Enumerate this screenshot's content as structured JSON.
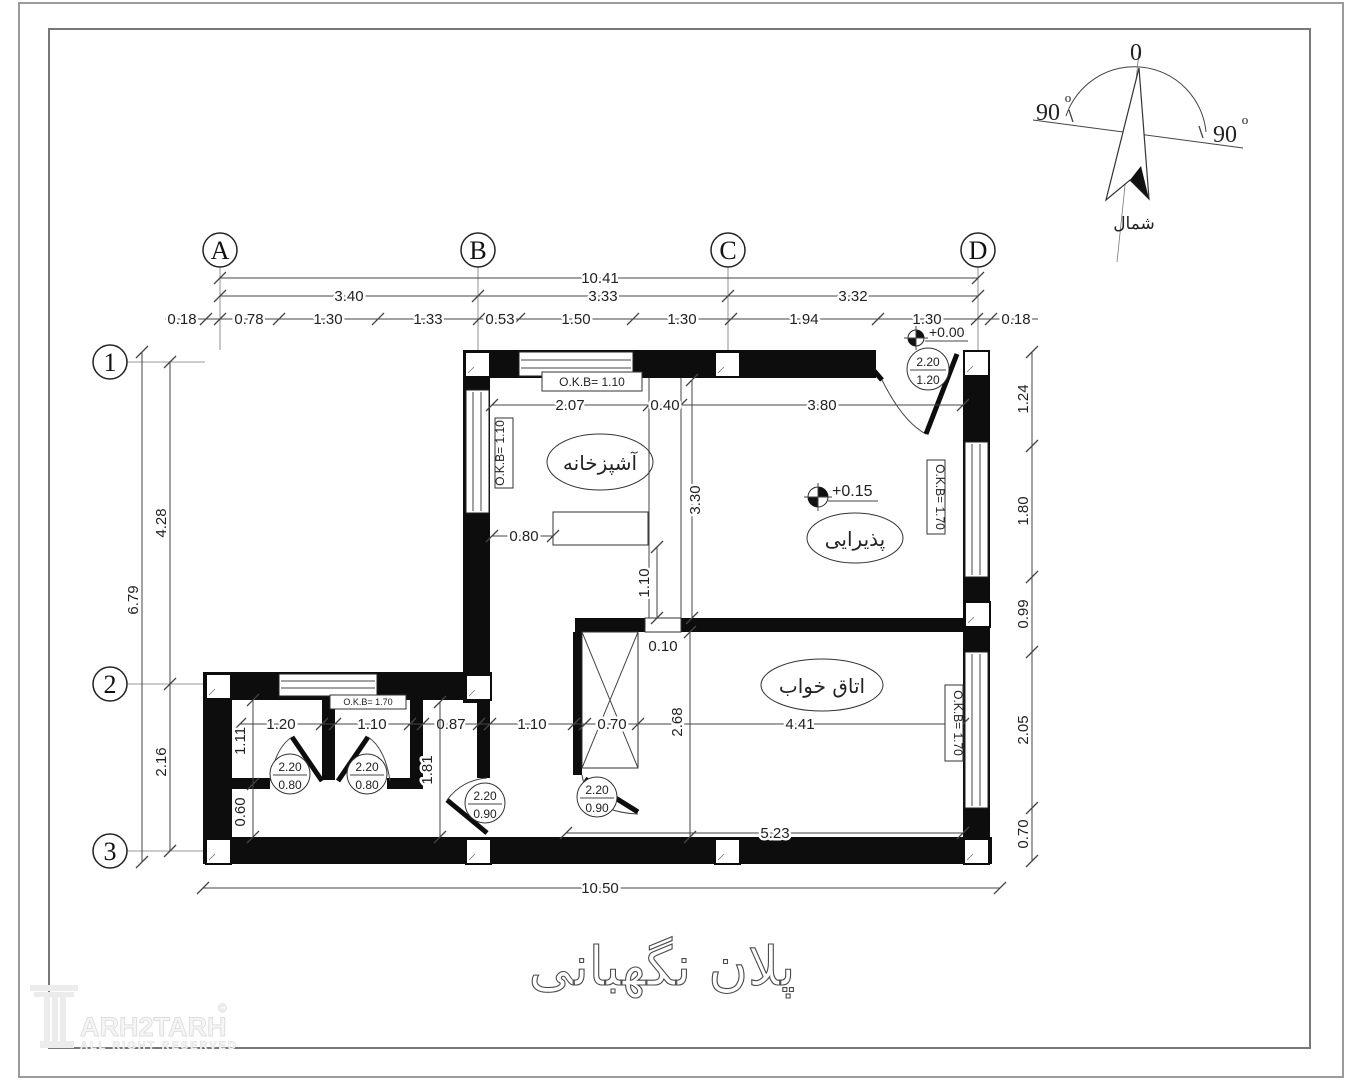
{
  "compass": {
    "zero": "0",
    "left_angle": "90",
    "right_angle": "90",
    "deg": "o",
    "north_label": "شمال"
  },
  "grid_columns": [
    "A",
    "B",
    "C",
    "D"
  ],
  "grid_rows": [
    "1",
    "2",
    "3"
  ],
  "dimensions": {
    "overall_top": "10.41",
    "bay_ab": "3.40",
    "bay_bc": "3.33",
    "bay_cd": "3.32",
    "top_details": [
      "0.18",
      "0.78",
      "1.30",
      "1.33",
      "0.53",
      "1.50",
      "1.30",
      "1.94",
      "1.30",
      "0.18"
    ],
    "left_overall": "6.79",
    "left_12": "4.28",
    "left_23": "2.16",
    "right": [
      "1.24",
      "1.80",
      "0.99",
      "2.05",
      "0.70"
    ],
    "overall_bottom": "10.50",
    "kitchen_width": "2.07",
    "partition_width": "0.40",
    "living_width": "3.80",
    "kitchen_depth": "3.30",
    "counter_offset": "0.80",
    "counter_to_wall": "1.10",
    "wall_niche": "0.10",
    "wc1_width": "1.20",
    "wc2_width": "1.10",
    "hall_width": "0.87",
    "hall_to_shaft": "1.10",
    "shaft_width": "0.70",
    "bedroom_depth": "2.68",
    "bedroom_width": "4.41",
    "bedroom_south": "5.23",
    "wc_depth": "1.11",
    "wc_lower": "0.60",
    "hall_depth": "1.81"
  },
  "rooms": {
    "kitchen": "آشپزخانه",
    "living": "پذیرایی",
    "bedroom": "اتاق خواب"
  },
  "okb_labels": {
    "top_window": "O.K.B= 1.10",
    "left_window": "O.K.B= 1.10",
    "right_upper_window": "O.K.B= 1.70",
    "right_lower_window": "O.K.B= 1.70",
    "wc_window": "O.K.B= 1.70"
  },
  "levels": {
    "entrance": "+0.00",
    "living": "+0.15"
  },
  "door_tags": {
    "entrance": {
      "height": "2.20",
      "width": "1.20"
    },
    "wc1": {
      "height": "2.20",
      "width": "0.80"
    },
    "wc2": {
      "height": "2.20",
      "width": "0.80"
    },
    "hall": {
      "height": "2.20",
      "width": "0.90"
    },
    "bedroom": {
      "height": "2.20",
      "width": "0.90"
    }
  },
  "title": "پلان نگهبانی",
  "watermark": {
    "brand": "ARH2TARH",
    "copyright": "©",
    "tagline": "ALL RIGHT RESERVED"
  }
}
